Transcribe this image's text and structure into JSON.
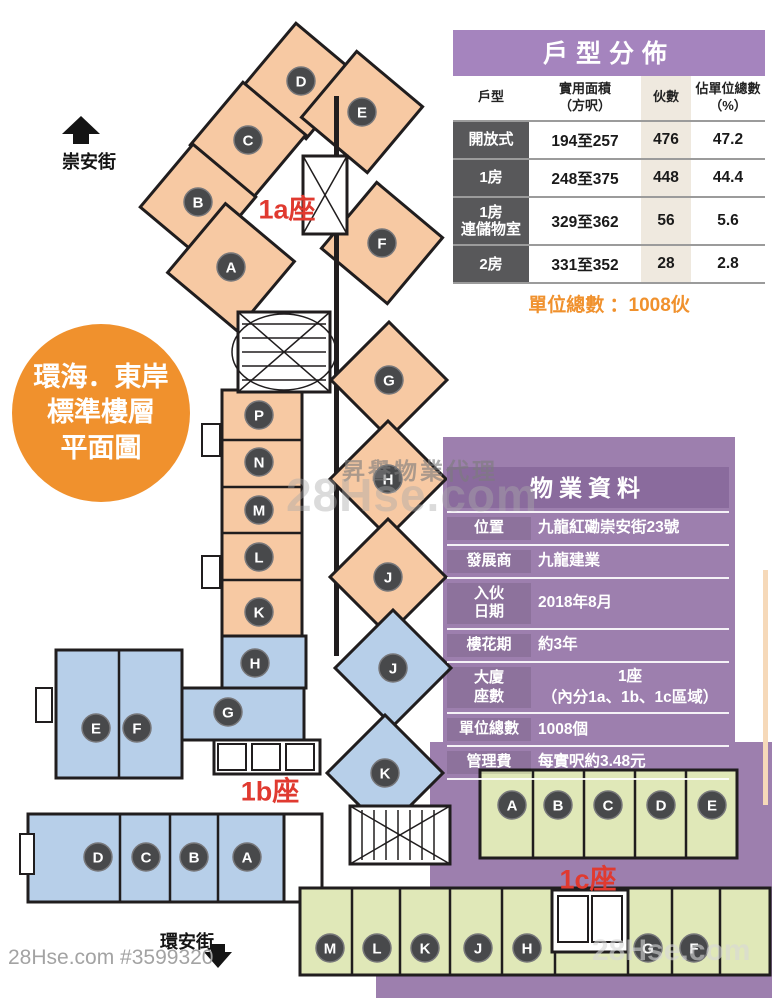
{
  "colors": {
    "wing_1a": "#f7c9a3",
    "wing_1b": "#b7cfe9",
    "wing_1c": "#e0e8b8",
    "purple_bg": "#9d7fae",
    "purple_header": "#a584be",
    "purple_dark": "#8a6b9d",
    "row_label_dark": "#58585a",
    "count_col_beige": "#efe9df",
    "accent_orange": "#f0912d",
    "wing_label_red": "#e03a30",
    "badge_circle": "#48494b"
  },
  "badge_circle": {
    "line1": "環海．東岸",
    "line2": "標準樓層",
    "line3": "平面圖"
  },
  "streets": {
    "top": "崇安街",
    "bottom": "環安街"
  },
  "unit_table": {
    "title": "戶型分佈",
    "headers": [
      [
        "戶型",
        ""
      ],
      [
        "實用面積",
        "（方呎）"
      ],
      [
        "伙數",
        ""
      ],
      [
        "佔單位總數",
        "（%）"
      ]
    ],
    "rows": [
      {
        "type": "開放式",
        "type2": "",
        "area": "194至257",
        "count": "476",
        "pct": "47.2"
      },
      {
        "type": "1房",
        "type2": "",
        "area": "248至375",
        "count": "448",
        "pct": "44.4"
      },
      {
        "type": "1房",
        "type2": "連儲物室",
        "area": "329至362",
        "count": "56",
        "pct": "5.6"
      },
      {
        "type": "2房",
        "type2": "",
        "area": "331至352",
        "count": "28",
        "pct": "2.8"
      }
    ],
    "footer": "單位總數 ：1008伙"
  },
  "property_table": {
    "title": "物業資料",
    "rows": [
      {
        "label": "位置",
        "value": "九龍紅磡崇安街23號"
      },
      {
        "label": "發展商",
        "value": "九龍建業"
      },
      {
        "label": "入伙",
        "label2": "日期",
        "value": "2018年8月"
      },
      {
        "label": "樓花期",
        "value": "約3年"
      },
      {
        "label": "大廈",
        "label2": "座數",
        "value": "1座",
        "value2": "（內分1a、1b、1c區域）"
      },
      {
        "label": "單位總數",
        "value": "1008個"
      },
      {
        "label": "管理費",
        "value": "每實呎約3.48元"
      }
    ]
  },
  "floorplan": {
    "wing_labels": [
      {
        "id": "1a",
        "text": "1a座"
      },
      {
        "id": "1b",
        "text": "1b座"
      },
      {
        "id": "1c",
        "text": "1c座"
      }
    ],
    "units": [
      {
        "wing": "1a",
        "label": "D",
        "x": 301,
        "y": 81
      },
      {
        "wing": "1a",
        "label": "C",
        "x": 248,
        "y": 140
      },
      {
        "wing": "1a",
        "label": "B",
        "x": 198,
        "y": 202
      },
      {
        "wing": "1a",
        "label": "A",
        "x": 231,
        "y": 267
      },
      {
        "wing": "1a",
        "label": "E",
        "x": 362,
        "y": 112
      },
      {
        "wing": "1a",
        "label": "F",
        "x": 382,
        "y": 243
      },
      {
        "wing": "1a",
        "label": "P",
        "x": 259,
        "y": 415
      },
      {
        "wing": "1a",
        "label": "N",
        "x": 259,
        "y": 462
      },
      {
        "wing": "1a",
        "label": "M",
        "x": 259,
        "y": 510
      },
      {
        "wing": "1a",
        "label": "L",
        "x": 259,
        "y": 557
      },
      {
        "wing": "1a",
        "label": "K",
        "x": 259,
        "y": 612
      },
      {
        "wing": "1a",
        "label": "G",
        "x": 389,
        "y": 380
      },
      {
        "wing": "1a",
        "label": "H",
        "x": 388,
        "y": 479
      },
      {
        "wing": "1a",
        "label": "J",
        "x": 388,
        "y": 577
      },
      {
        "wing": "1b",
        "label": "H",
        "x": 255,
        "y": 663
      },
      {
        "wing": "1b",
        "label": "G",
        "x": 228,
        "y": 712
      },
      {
        "wing": "1b",
        "label": "E",
        "x": 96,
        "y": 728
      },
      {
        "wing": "1b",
        "label": "F",
        "x": 137,
        "y": 728
      },
      {
        "wing": "1b",
        "label": "J",
        "x": 393,
        "y": 668
      },
      {
        "wing": "1b",
        "label": "K",
        "x": 385,
        "y": 773
      },
      {
        "wing": "1b",
        "label": "D",
        "x": 98,
        "y": 857
      },
      {
        "wing": "1b",
        "label": "C",
        "x": 146,
        "y": 857
      },
      {
        "wing": "1b",
        "label": "B",
        "x": 194,
        "y": 857
      },
      {
        "wing": "1b",
        "label": "A",
        "x": 247,
        "y": 857
      },
      {
        "wing": "1c",
        "label": "A",
        "x": 512,
        "y": 805
      },
      {
        "wing": "1c",
        "label": "B",
        "x": 558,
        "y": 805
      },
      {
        "wing": "1c",
        "label": "C",
        "x": 608,
        "y": 805
      },
      {
        "wing": "1c",
        "label": "D",
        "x": 661,
        "y": 805
      },
      {
        "wing": "1c",
        "label": "E",
        "x": 712,
        "y": 805
      },
      {
        "wing": "1c",
        "label": "M",
        "x": 330,
        "y": 948
      },
      {
        "wing": "1c",
        "label": "L",
        "x": 377,
        "y": 948
      },
      {
        "wing": "1c",
        "label": "K",
        "x": 425,
        "y": 948
      },
      {
        "wing": "1c",
        "label": "J",
        "x": 478,
        "y": 948
      },
      {
        "wing": "1c",
        "label": "H",
        "x": 527,
        "y": 948
      },
      {
        "wing": "1c",
        "label": "G",
        "x": 648,
        "y": 948
      },
      {
        "wing": "1c",
        "label": "F",
        "x": 694,
        "y": 948
      }
    ]
  },
  "watermarks": {
    "bottom_left": "28Hse.com #3599320",
    "agency": "昇譽物業代理",
    "center": "28Hse.com",
    "bottom_right": "28Hse.com"
  }
}
